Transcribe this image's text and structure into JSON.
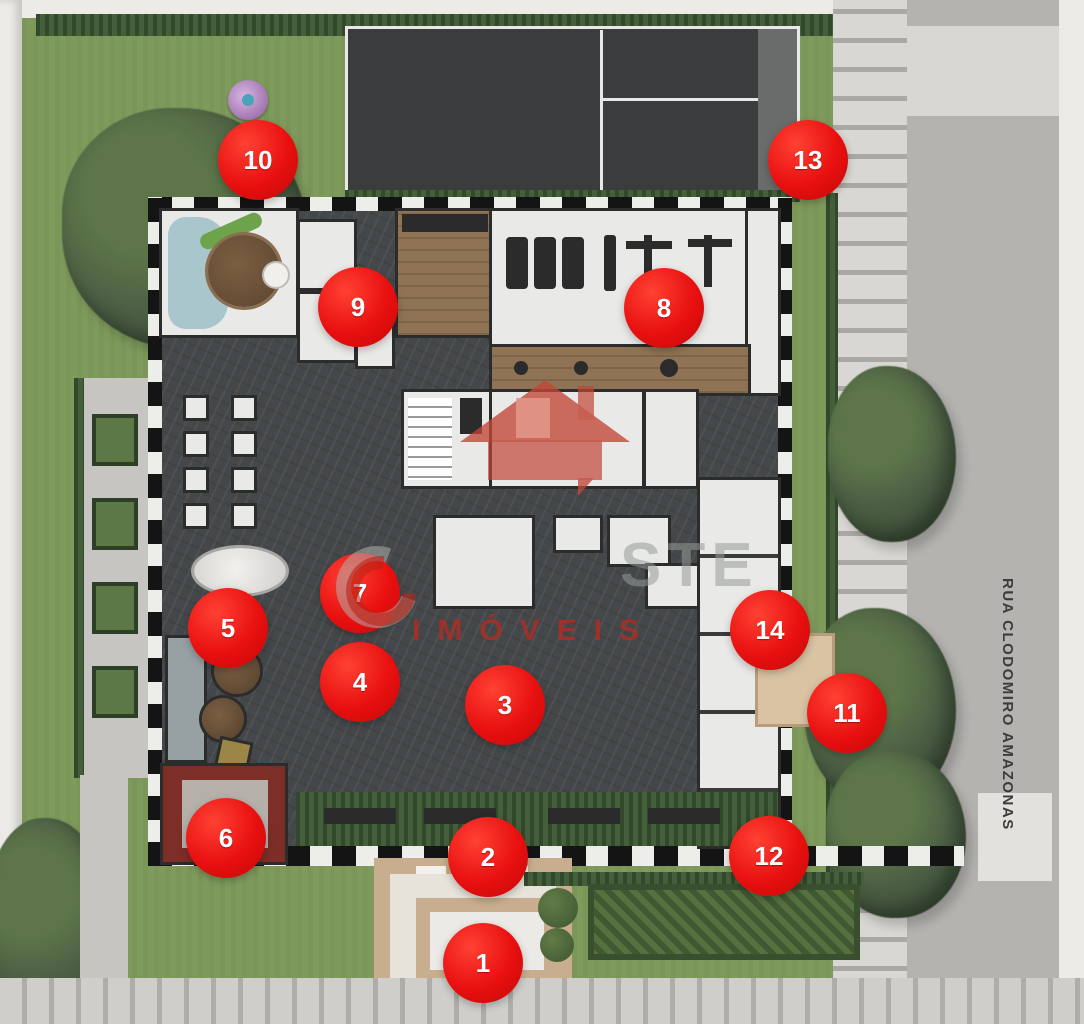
{
  "street": {
    "label": "RUA CLODOMIRO AMAZONAS"
  },
  "watermark": {
    "logo": "red-house-icon",
    "brand_fragment": "STE",
    "label": "IMÓVEIS",
    "accent": "#c0392b"
  },
  "markers": [
    {
      "n": "1",
      "x": 483,
      "y": 963
    },
    {
      "n": "2",
      "x": 488,
      "y": 857
    },
    {
      "n": "3",
      "x": 505,
      "y": 705
    },
    {
      "n": "4",
      "x": 360,
      "y": 682
    },
    {
      "n": "5",
      "x": 228,
      "y": 628
    },
    {
      "n": "6",
      "x": 226,
      "y": 838
    },
    {
      "n": "7",
      "x": 360,
      "y": 593
    },
    {
      "n": "8",
      "x": 664,
      "y": 308
    },
    {
      "n": "9",
      "x": 358,
      "y": 307
    },
    {
      "n": "10",
      "x": 258,
      "y": 160
    },
    {
      "n": "11",
      "x": 847,
      "y": 713
    },
    {
      "n": "12",
      "x": 769,
      "y": 856
    },
    {
      "n": "13",
      "x": 808,
      "y": 160
    },
    {
      "n": "14",
      "x": 770,
      "y": 630
    }
  ],
  "colors": {
    "marker_red": "#e81010",
    "watermark_red": "#c0392b",
    "lawn_green": "#7f9b5c",
    "building_slab": "#45484a",
    "road_gray": "#b4b3b0",
    "plaza_beige": "#c8ae8e"
  }
}
